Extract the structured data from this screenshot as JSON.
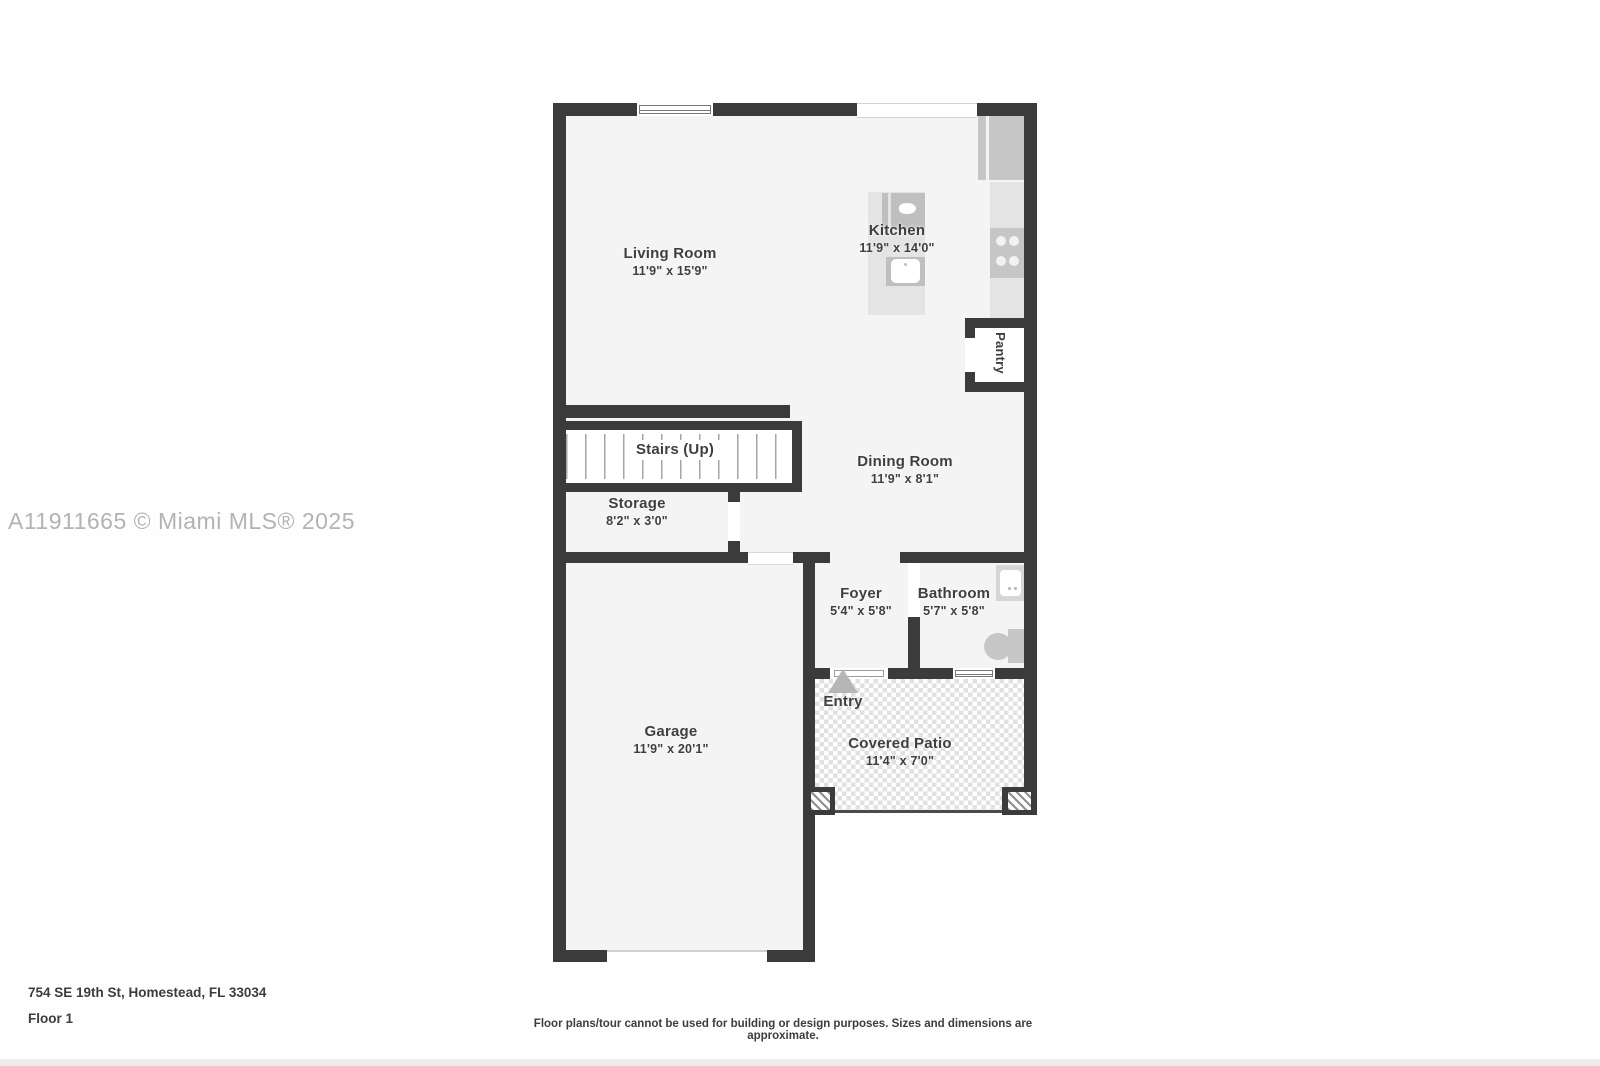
{
  "watermark": {
    "text": "A11911665 © Miami MLS® 2025"
  },
  "footer": {
    "address": "754 SE 19th St, Homestead, FL 33034",
    "floor_label": "Floor 1",
    "disclaimer": "Floor plans/tour cannot be used for building or design purposes. Sizes and dimensions are approximate."
  },
  "rooms": {
    "living_room": {
      "name": "Living Room",
      "dims": "11'9\" x 15'9\""
    },
    "kitchen": {
      "name": "Kitchen",
      "dims": "11'9\" x 14'0\""
    },
    "pantry": {
      "name": "Pantry"
    },
    "stairs": {
      "name": "Stairs (Up)"
    },
    "storage": {
      "name": "Storage",
      "dims": "8'2\" x 3'0\""
    },
    "dining_room": {
      "name": "Dining Room",
      "dims": "11'9\" x 8'1\""
    },
    "foyer": {
      "name": "Foyer",
      "dims": "5'4\" x 5'8\""
    },
    "bathroom": {
      "name": "Bathroom",
      "dims": "5'7\" x 5'8\""
    },
    "entry": {
      "name": "Entry"
    },
    "garage": {
      "name": "Garage",
      "dims": "11'9\" x 20'1\""
    },
    "covered_patio": {
      "name": "Covered Patio",
      "dims": "11'4\" x 7'0\""
    }
  },
  "colors": {
    "wall": "#3b3b3b",
    "floor": "#f4f4f4",
    "fixture": "#c6c6c6",
    "fixture-dark": "#bfbfbf",
    "counter": "#e4e4e4",
    "label": "#3f3f3f",
    "watermark": "#b3b3b3",
    "patio-square": "#e0e0e0"
  }
}
